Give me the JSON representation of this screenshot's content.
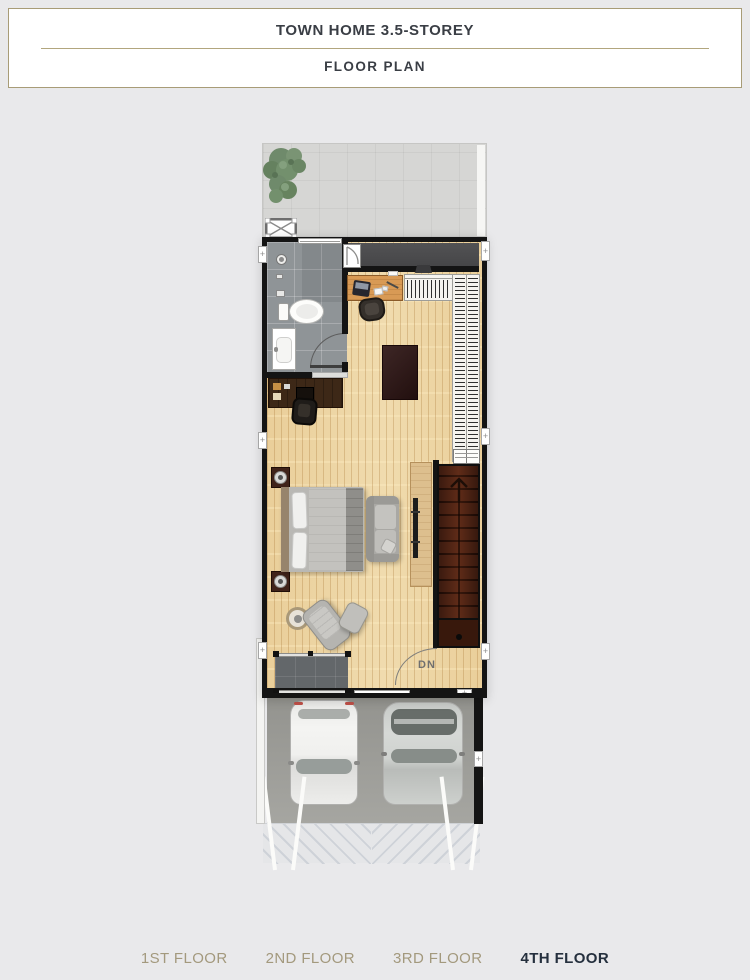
{
  "header": {
    "title": "TOWN HOME 3.5-STOREY",
    "subtitle": "FLOOR PLAN"
  },
  "tabs": [
    {
      "label": "1ST FLOOR",
      "active": false
    },
    {
      "label": "2ND FLOOR",
      "active": false
    },
    {
      "label": "3RD FLOOR",
      "active": false
    },
    {
      "label": "4TH FLOOR",
      "active": true
    }
  ],
  "plan": {
    "stairs_down_label": "DN"
  },
  "colors": {
    "header_border": "#a89c77",
    "divider": "#b2a67e",
    "title_text": "#3a3e45",
    "tab_inactive": "#a3997d",
    "tab_active": "#25303e",
    "wall": "#141414",
    "wood_floor": "#eed8a9",
    "bath_tile": "#8f9497",
    "terrace": "#d6d6d4",
    "corridor": "#4a4a4c",
    "stair_brown": "#4e2314",
    "tree_green": "#6f8a6b"
  }
}
